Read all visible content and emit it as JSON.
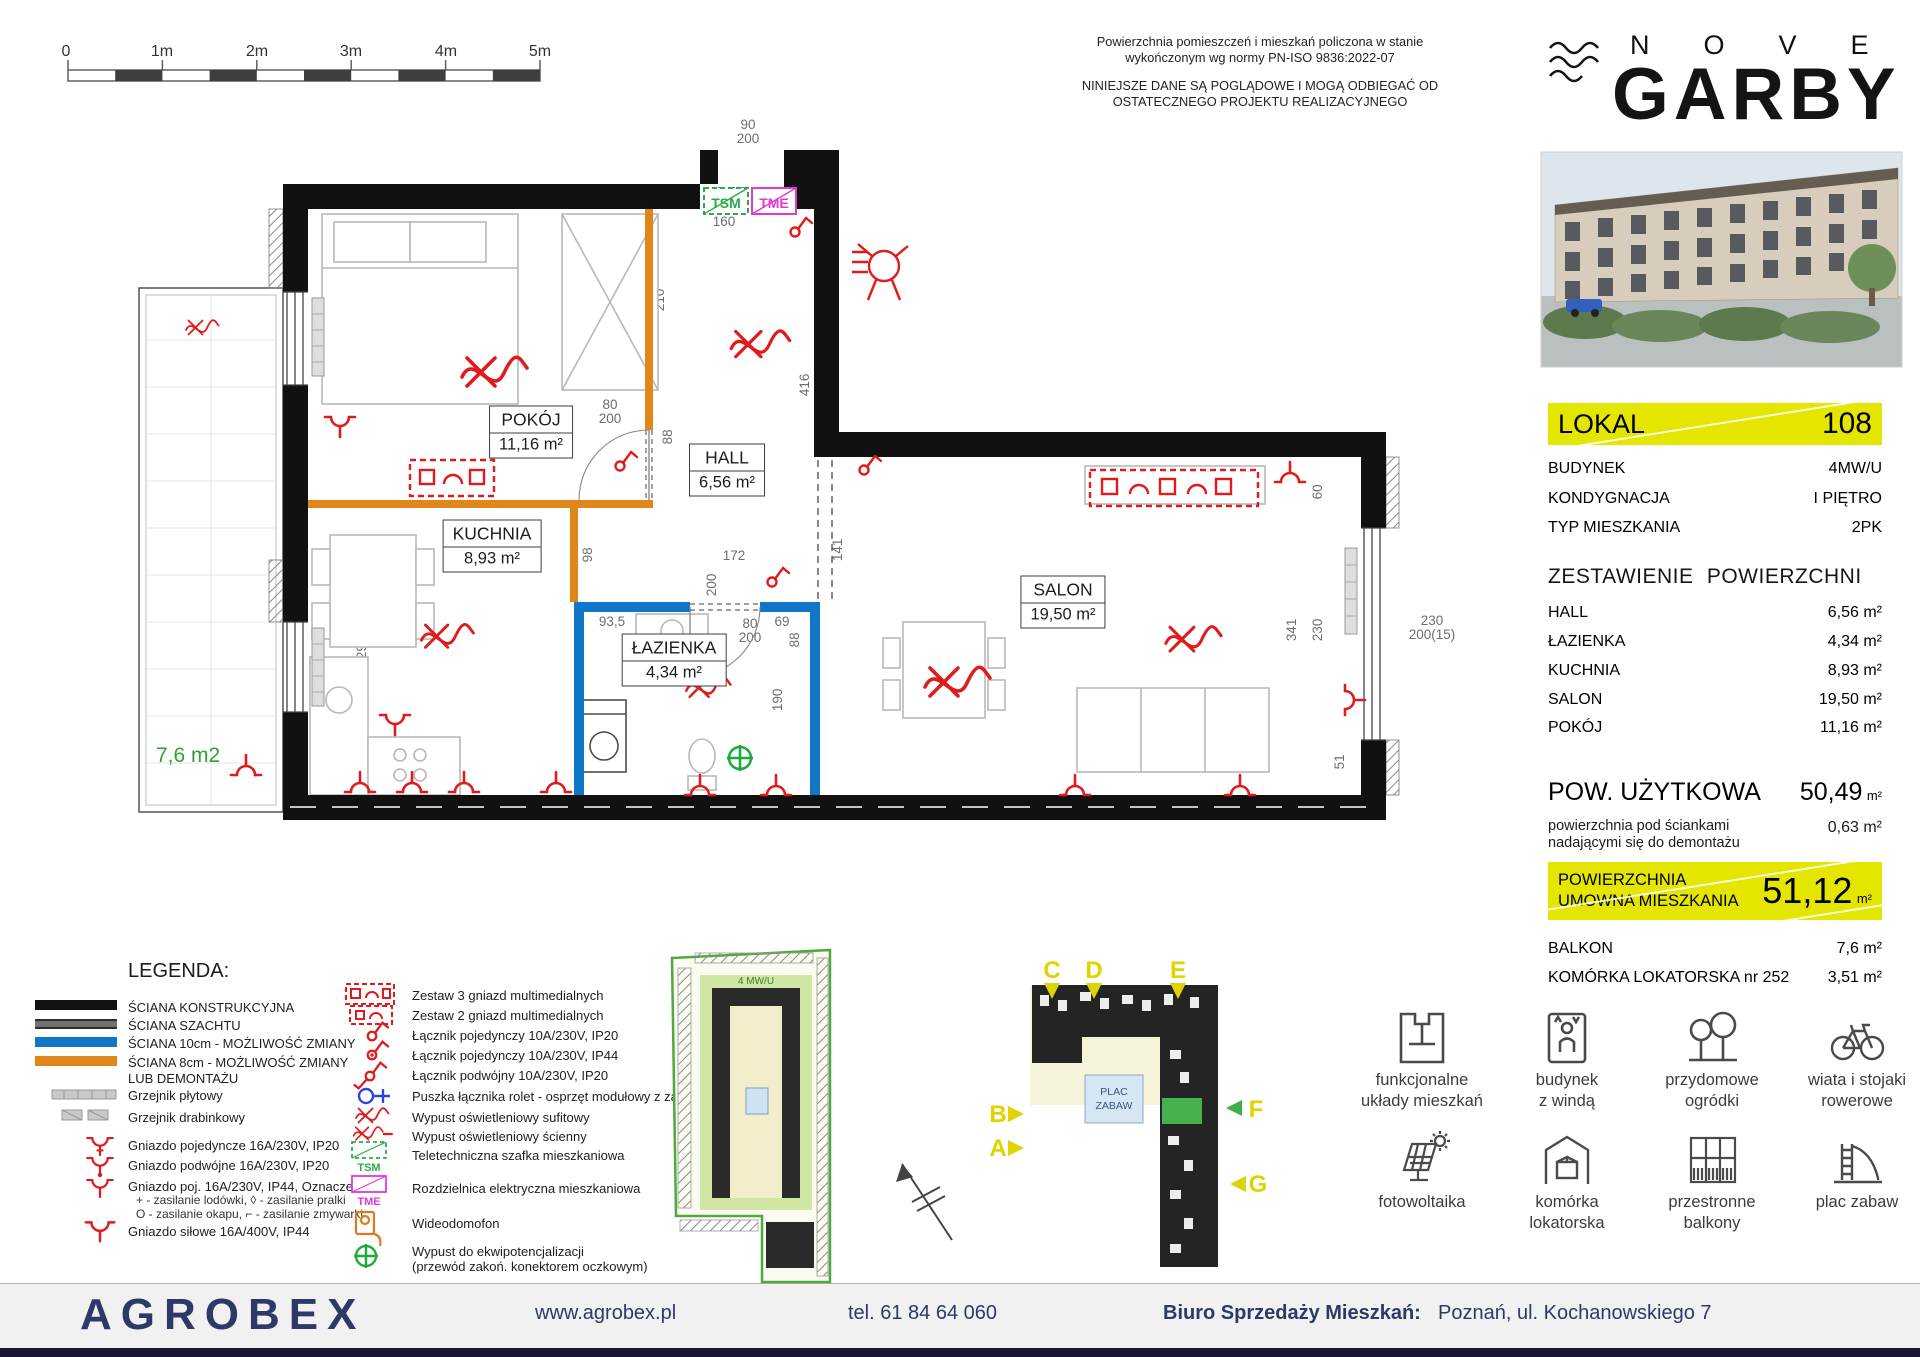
{
  "scalebar": {
    "labels": [
      "0",
      "1m",
      "2m",
      "3m",
      "4m",
      "5m"
    ]
  },
  "disclaimer": {
    "line1": "Powierzchnia pomieszczeń i mieszkań policzona w stanie",
    "line2": "wykończonym wg normy PN-ISO 9836:2022-07",
    "line3": "NINIEJSZE DANE SĄ POGLĄDOWE I MOGĄ ODBIEGAĆ OD",
    "line4": "OSTATECZNEGO PROJEKTU REALIZACYJNEGO"
  },
  "brand": {
    "nove": "NOVE",
    "garby": "GARBY"
  },
  "panel": {
    "lokal_label": "LOKAL",
    "lokal_number": "108",
    "fields": [
      {
        "label": "BUDYNEK",
        "value": "4MW/U"
      },
      {
        "label": "KONDYGNACJA",
        "value": "I PIĘTRO"
      },
      {
        "label": "TYP MIESZKANIA",
        "value": "2PK"
      }
    ],
    "areas_title": "ZESTAWIENIE POWIERZCHNI",
    "rooms": [
      {
        "name": "HALL",
        "area": "6,56 m²"
      },
      {
        "name": "ŁAZIENKA",
        "area": "4,34 m²"
      },
      {
        "name": "KUCHNIA",
        "area": "8,93 m²"
      },
      {
        "name": "SALON",
        "area": "19,50 m²"
      },
      {
        "name": "POKÓJ",
        "area": "11,16 m²"
      }
    ],
    "usable_label": "POW. UŻYTKOWA",
    "usable_value": "50,49",
    "usable_unit": "m²",
    "demolish_label": "powierzchnia pod ściankami\nnadającymi się do demontażu",
    "demolish_value": "0,63 m²",
    "contract_label": "POWIERZCHNIA\nUMOWNA MIESZKANIA",
    "contract_value": "51,12",
    "contract_unit": "m²",
    "extras": [
      {
        "label": "BALKON",
        "value": "7,6 m²"
      },
      {
        "label": "KOMÓRKA LOKATORSKA nr 252",
        "value": "3,51 m²"
      }
    ]
  },
  "plan": {
    "rooms": [
      {
        "name": "POKÓJ",
        "area": "11,16 m²"
      },
      {
        "name": "HALL",
        "area": "6,56 m²"
      },
      {
        "name": "KUCHNIA",
        "area": "8,93 m²"
      },
      {
        "name": "ŁAZIENKA",
        "area": "4,34 m²"
      },
      {
        "name": "SALON",
        "area": "19,50 m²"
      }
    ],
    "balcony_area": "7,6 m2",
    "tsm": "TSM",
    "tme": "TME",
    "dims": [
      "363",
      "110",
      "310",
      "310",
      "160",
      "90\n200",
      "210",
      "80\n200",
      "88",
      "416",
      "141",
      "172",
      "200",
      "98",
      "80\n200",
      "88",
      "118",
      "298",
      "190",
      "93,5",
      "69",
      "525",
      "341",
      "230",
      "60",
      "51",
      "100\n215(0)",
      "150",
      "140",
      "540",
      "100\n215(0)",
      "230\n200(15)"
    ]
  },
  "legend": {
    "title": "LEGENDA:",
    "walls": [
      "ŚCIANA KONSTRUKCYJNA",
      "ŚCIANA SZACHTU",
      "ŚCIANA 10cm - MOŻLIWOŚĆ ZMIANY",
      "ŚCIANA 8cm - MOŻLIWOŚĆ ZMIANY\nLUB DEMONTAŻU"
    ],
    "items_left": [
      "Grzejnik płytowy",
      "Grzejnik drabinkowy",
      "Gniazdo pojedyncze 16A/230V, IP20",
      "Gniazdo podwójne 16A/230V, IP20",
      "Gniazdo poj. 16A/230V, IP44, Oznaczenia:",
      "+  - zasilanie lodówki,  ◊  - zasilanie pralki",
      "O  - zasilanie okapu,  ⌐ - zasilanie zmywarki",
      "Gniazdo siłowe 16A/400V, IP44"
    ],
    "items_right": [
      "Zestaw 3 gniazd multimedialnych",
      "Zestaw 2 gniazd multimedialnych",
      "Łącznik pojedynczy 10A/230V, IP20",
      "Łącznik pojedynczy 10A/230V, IP44",
      "Łącznik podwójny 10A/230V, IP20",
      "Puszka łącznika rolet - osprzęt modułowy z zaślepką",
      "Wypust oświetleniowy sufitowy",
      "Wypust oświetleniowy ścienny",
      "Teletechniczna szafka mieszkaniowa",
      "Rozdzielnica elektryczna mieszkaniowa",
      "Wideodomofon",
      "Wypust do ekwipotencjalizacji",
      "(przewód zakoń. konektorem oczkowym)"
    ],
    "tsm": "TSM",
    "tme": "TME"
  },
  "maps": {
    "site_label": "PLAN OSIEDLA",
    "building_label": "LOKALIZACJA  W BUDYNKU",
    "site_tag": "4 MW/U",
    "plac1": "PLAC",
    "plac2": "ZABAW",
    "markers": [
      "C",
      "D",
      "E",
      "B",
      "A",
      "F",
      "G"
    ]
  },
  "features": [
    {
      "label1": "funkcjonalne",
      "label2": "układy mieszkań"
    },
    {
      "label1": "budynek",
      "label2": "z windą"
    },
    {
      "label1": "przydomowe",
      "label2": "ogródki"
    },
    {
      "label1": "wiata i stojaki",
      "label2": "rowerowe"
    },
    {
      "label1": "fotowoltaika",
      "label2": ""
    },
    {
      "label1": "komórka",
      "label2": "lokatorska"
    },
    {
      "label1": "przestronne",
      "label2": "balkony"
    },
    {
      "label1": "plac zabaw",
      "label2": ""
    }
  ],
  "footer": {
    "brand": "AGROBEX",
    "website": "www.agrobex.pl",
    "phone": "tel. 61 84 64 060",
    "office_label": "Biuro Sprzedaży Mieszkań:",
    "office_address": "Poznań, ul. Kochanowskiego 7"
  }
}
